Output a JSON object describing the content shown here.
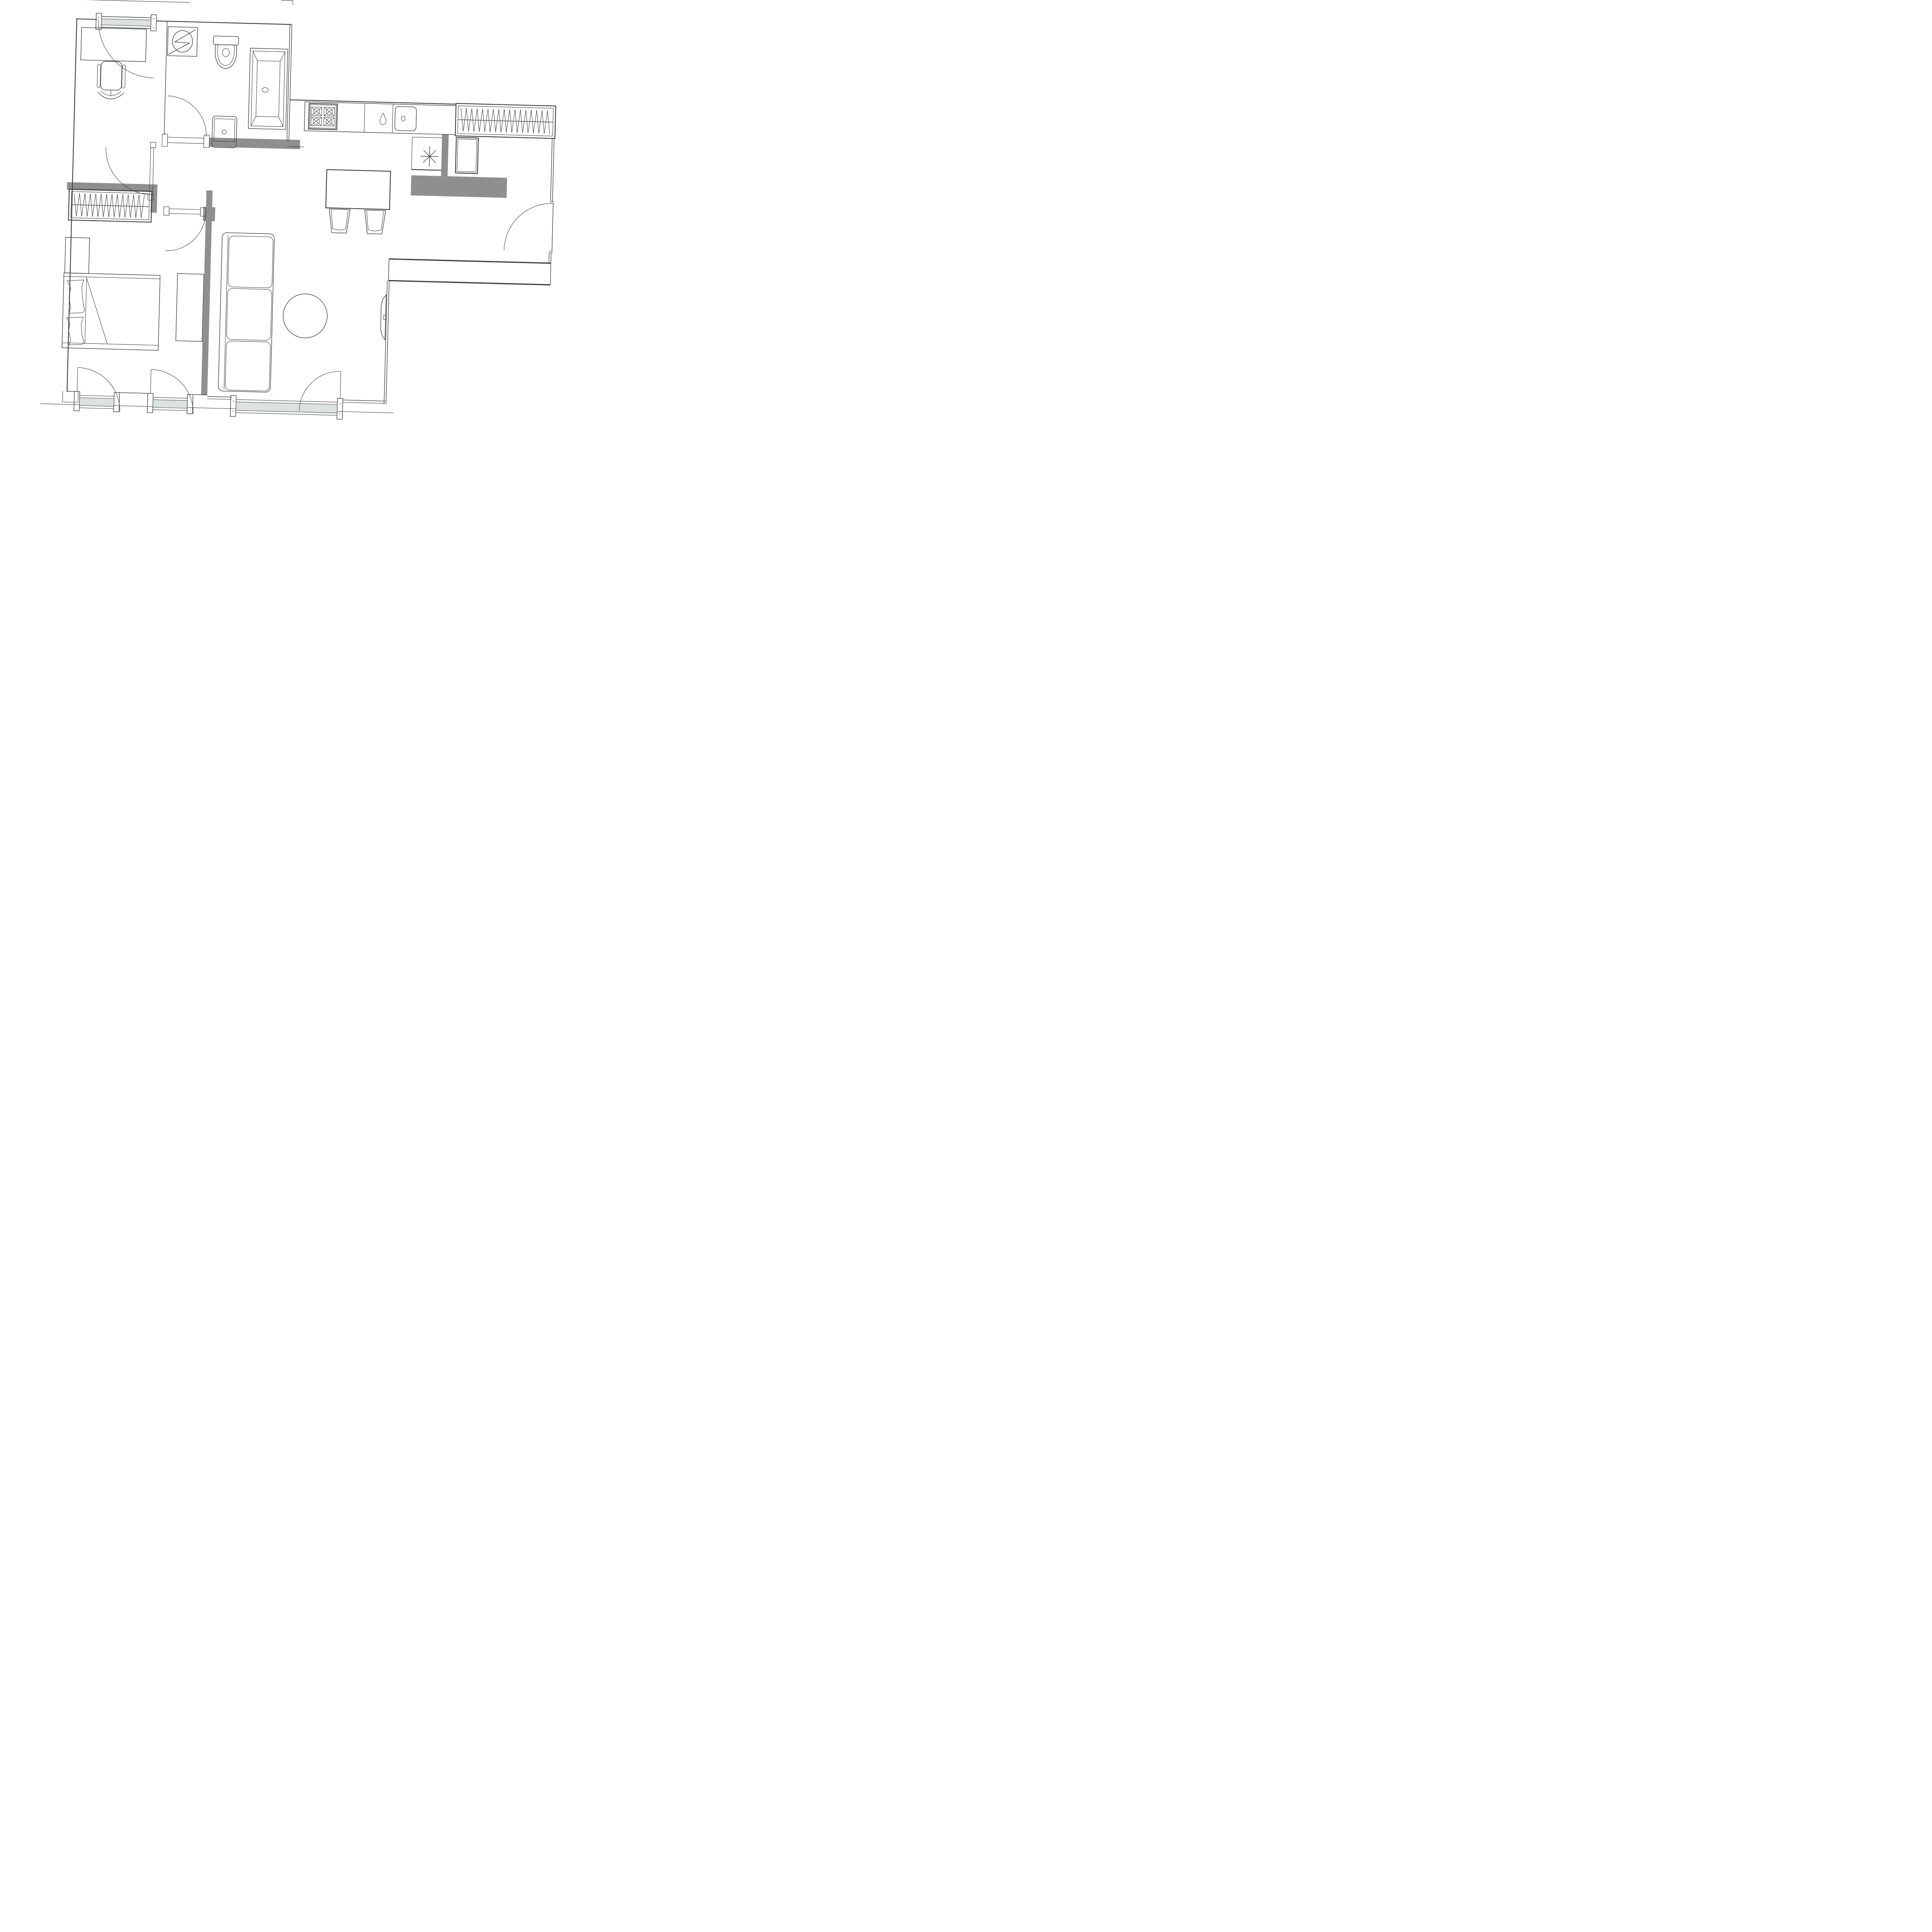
{
  "document": {
    "kind": "architectural-floor-plan",
    "description": "Monochrome apartment floor plan drawing, slightly tilted, no text labels",
    "rotation_deg": 1.5,
    "background": "#ffffff",
    "line_color": "#3e3e3e",
    "wall_fill": "#8f8f8f",
    "glazing_fill": "#dbe2e0"
  },
  "rooms": [
    {
      "name": "office",
      "label": "Office",
      "fixtures": [
        "desk",
        "swivel office chair",
        "north window with swing leaf",
        "door to hallway"
      ]
    },
    {
      "name": "bathroom",
      "label": "Bathroom",
      "fixtures": [
        "washing machine",
        "toilet",
        "bathtub with drain",
        "washbasin",
        "door to hallway"
      ]
    },
    {
      "name": "kitchen",
      "label": "Kitchen",
      "fixtures": [
        "counter run",
        "four-burner hob",
        "water-drop faucet symbol",
        "sink",
        "island",
        "two bar stools",
        "boiler closet with asterisk symbol",
        "tall cabinet"
      ]
    },
    {
      "name": "hallway",
      "label": "Hallway",
      "fixtures": [
        "hall wardrobe with hanger hatching"
      ]
    },
    {
      "name": "bedroom",
      "label": "Bedroom",
      "fixtures": [
        "wardrobe with hanger hatching",
        "nightstand",
        "double bed with two pillows and duvet fold",
        "dresser",
        "two balcony windows with swing leaves",
        "door to hallway"
      ]
    },
    {
      "name": "living-room",
      "label": "Living room",
      "fixtures": [
        "three-cushion sofa",
        "round table",
        "wall-mounted TV",
        "wide balcony window with swing leaf",
        "entrance door",
        "balcony parapet"
      ]
    }
  ],
  "counts": {
    "swing_door_arcs": 7,
    "glazed_openings": 4,
    "wardrobes": 2,
    "gray_wall_segments": 7
  }
}
